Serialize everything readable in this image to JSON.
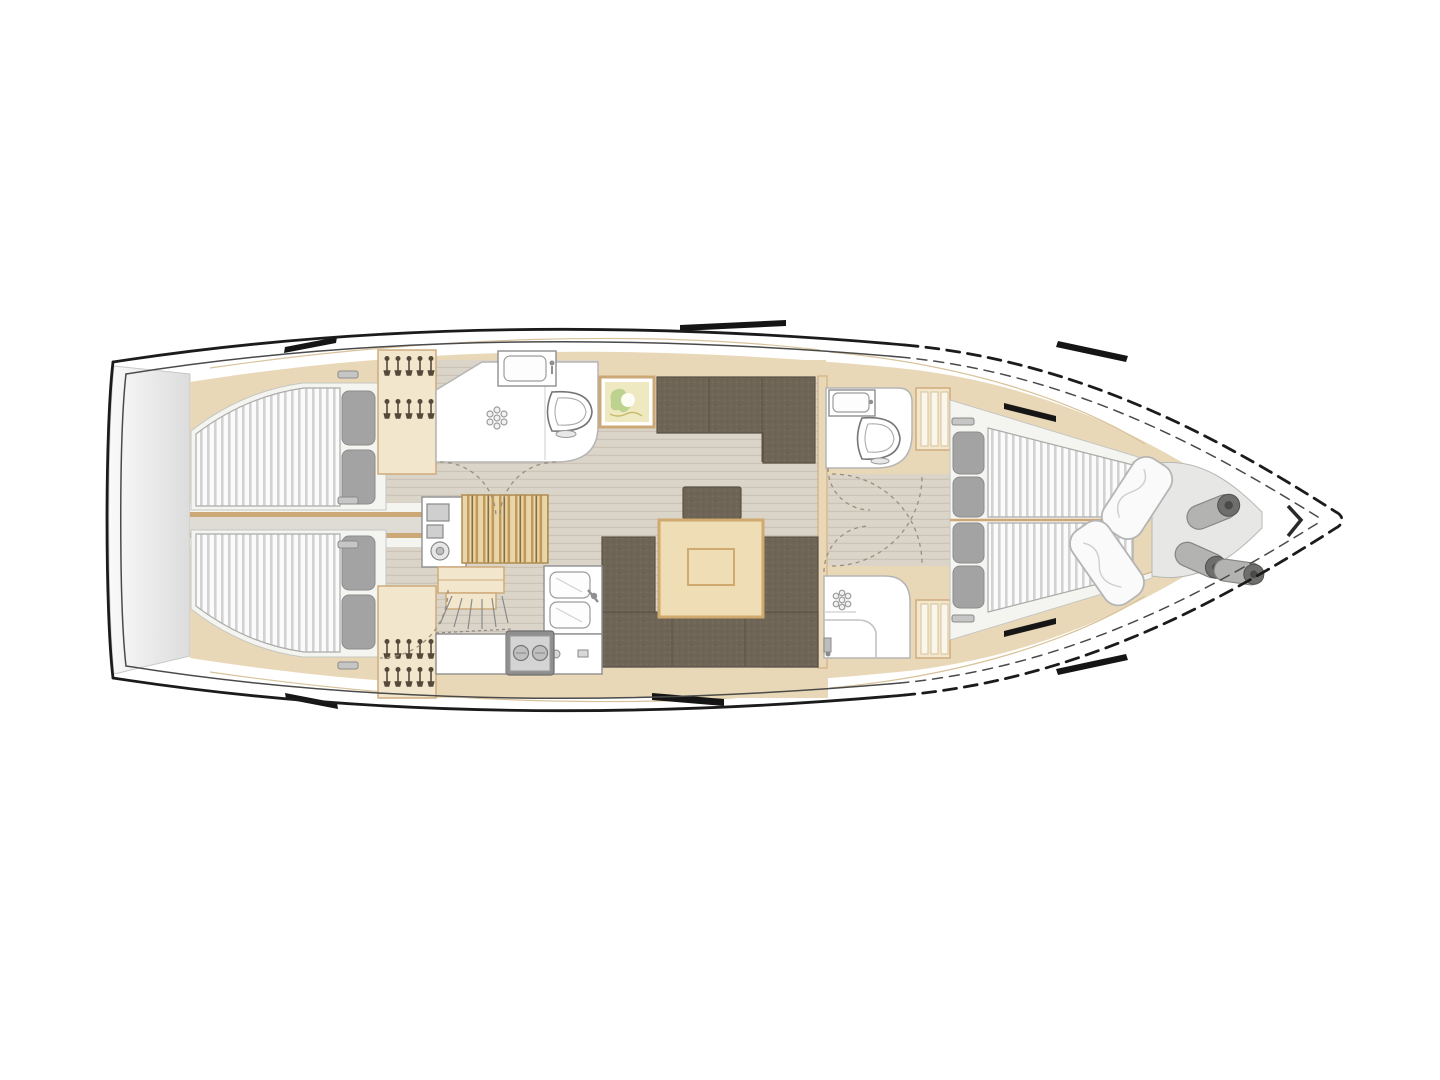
{
  "meta": {
    "diagram_type": "sailing-yacht-interior-floor-plan",
    "view": "top-down",
    "orientation": "bow-right"
  },
  "colors": {
    "line": "#1b1b1b",
    "deckline": "#4a4a4a",
    "wood": "#e9d8b8",
    "woodLight": "#f2e7cd",
    "woodBorder": "#cda877",
    "woodTrim": "#d8c29a",
    "floor": "#dbd4c8",
    "floorLine": "#ccc4b6",
    "table": "#efddb5",
    "tableBorder": "#cfa96e",
    "settee": "#6f6557",
    "setteeSeam": "#5a5245",
    "mattress": "#fbfbfb",
    "mattressStripe": "#d2d2d2",
    "pillow": "#a3a3a3",
    "transomA": "#fafafa",
    "transomB": "#dcdcdc",
    "locker": "#e7e7e5",
    "fender": "#b3b3b1",
    "fenderCap": "#6e6e6c",
    "seatA": "#e8d5a9",
    "seatB": "#c19a58",
    "seatC": "#8a6b3e",
    "chartBg": "#efe9c2",
    "chartGreen": "#b9d18c",
    "arc": "#9a8f7d",
    "grayZone": "#dfdbd5",
    "roomStroke": "#b5b5b5"
  },
  "rooms": [
    {
      "id": "swim-platform",
      "label": "Transom swim platform"
    },
    {
      "id": "aft-cabin-port",
      "label": "Aft double cabin, port side, with berth and pillows"
    },
    {
      "id": "aft-cabin-starboard",
      "label": "Aft double cabin, starboard side, with berth and pillows"
    },
    {
      "id": "engine-corridor",
      "label": "Engine room access corridor between aft cabins"
    },
    {
      "id": "wardrobe-aft-port",
      "label": "Aft wardrobe with hangers, port"
    },
    {
      "id": "wardrobe-aft-starboard",
      "label": "Aft wardrobe with hangers, starboard"
    },
    {
      "id": "aft-head",
      "label": "Aft head with shower, WC and washbasin"
    },
    {
      "id": "nav-station",
      "label": "Navigation station with chart desk and upholstered seat"
    },
    {
      "id": "companionway",
      "label": "Companionway steps"
    },
    {
      "id": "salon",
      "label": "Salon with settees and folding table"
    },
    {
      "id": "galley",
      "label": "Galley with twin sinks, stove and worktops"
    },
    {
      "id": "forward-head",
      "label": "Forward head with WC and washbasin"
    },
    {
      "id": "forward-shower",
      "label": "Forward shower compartment"
    },
    {
      "id": "forward-cabin",
      "label": "Forward cabin with V-berths"
    },
    {
      "id": "sail-locker",
      "label": "Bow sail locker with sails and fenders"
    }
  ],
  "features": {
    "hull": {
      "label": "Hull outline"
    },
    "deck_line": {
      "label": "Deck edge line"
    },
    "chart_picture": {
      "label": "Framed chart over sideboard"
    },
    "long_settee": {
      "label": "Straight settee, port side of salon"
    },
    "u_settee": {
      "label": "U-shaped dinette settee"
    },
    "stool": {
      "label": "Salon stool"
    },
    "table": {
      "label": "Salon table with fold-out leaf"
    },
    "nav_seat": {
      "label": "Navigator seat"
    },
    "chart_desk": {
      "label": "Chart desk with instruments"
    },
    "stove": {
      "label": "Two-burner stove"
    },
    "double_sink": {
      "label": "Twin galley sinks with mixer tap"
    },
    "worktop": {
      "label": "Galley worktop"
    },
    "toilet": {
      "label": "Marine toilet"
    },
    "washbasin": {
      "label": "Washbasin"
    },
    "shower_drain": {
      "label": "Shower drain"
    },
    "berth": {
      "label": "Double berth with sprung mattress"
    },
    "vee_berth": {
      "label": "V-berth mattress"
    },
    "pillow": {
      "label": "Pillow"
    },
    "hanger": {
      "label": "Clothes hangers"
    },
    "shelves": {
      "label": "Shelved locker"
    },
    "deck_hatch": {
      "label": "Deck hatch / hull window"
    },
    "sails": {
      "label": "Stowed sails"
    },
    "fenders": {
      "label": "Fenders"
    },
    "steps": {
      "label": "Companionway ladder"
    },
    "door_arc": {
      "label": "Door swing"
    },
    "stem": {
      "label": "Bow stem fitting"
    }
  }
}
